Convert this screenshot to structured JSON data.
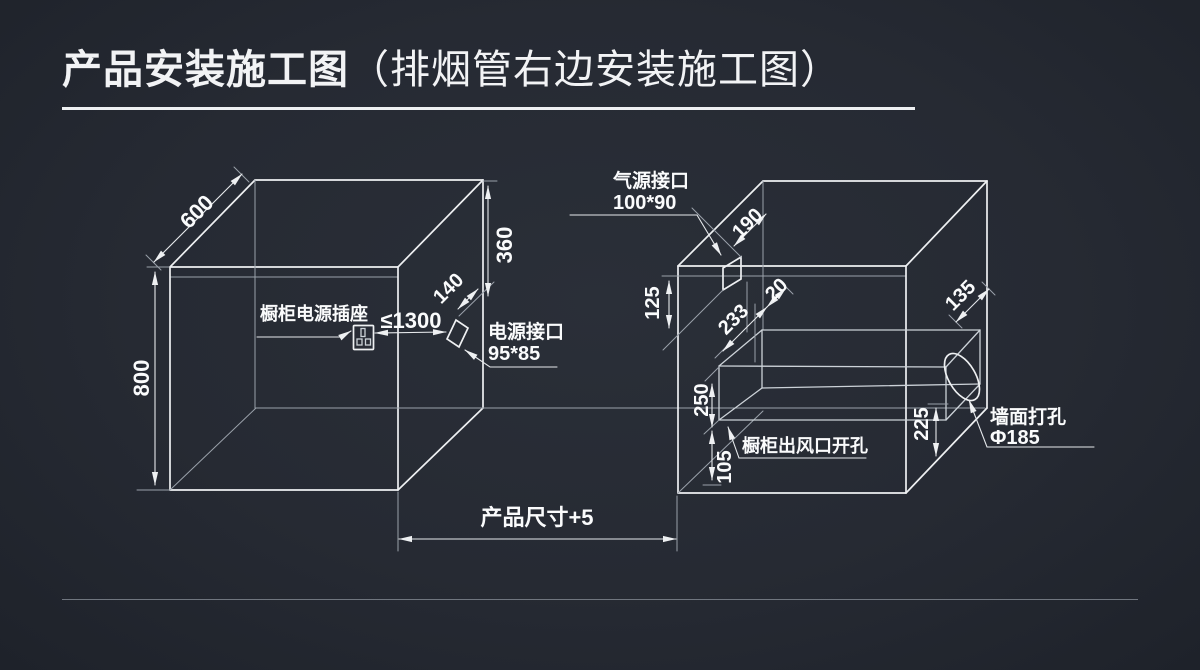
{
  "title": {
    "main": "产品安装施工图",
    "paren": "（排烟管右边安装施工图）"
  },
  "colors": {
    "background": "#262a33",
    "line": "#eef0f2",
    "thin_line": "#9aa1aa",
    "text": "#fafbfc"
  },
  "left_cabinet": {
    "depth": "600",
    "height": "800",
    "drop_to_port": "360",
    "port_offset": "140",
    "socket_distance": "≤1300",
    "socket_label": "橱柜电源插座",
    "power_port_label": "电源接口",
    "power_port_size": "95*85"
  },
  "right_cabinet": {
    "gas_port_label": "气源接口",
    "gas_port_size": "100*90",
    "gas_offset": "190",
    "top_clearance": "125",
    "duct_left_offset": "233",
    "duct_gap": "20",
    "wall_offset": "135",
    "duct_height": "250",
    "duct_bottom": "105",
    "hole_height": "225",
    "outlet_label": "橱柜出风口开孔",
    "wall_hole_label": "墙面打孔",
    "wall_hole_size": "Φ185"
  },
  "footer": {
    "product_width": "产品尺寸+5"
  }
}
